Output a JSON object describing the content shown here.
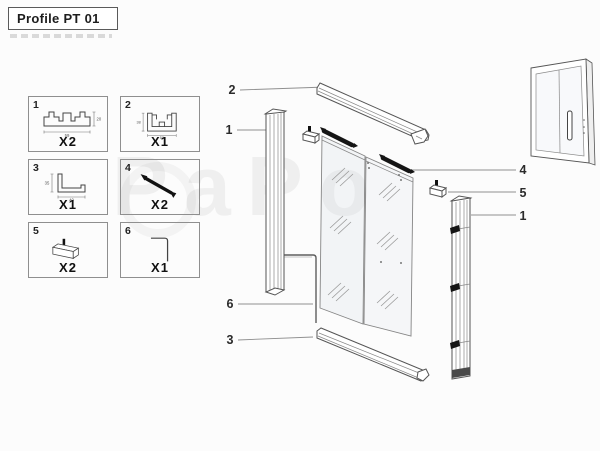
{
  "title": "Profile PT 01",
  "watermark": "PaPo",
  "parts": [
    {
      "num": "1",
      "qty": "X2",
      "dim_w": "59",
      "dim_h": "20"
    },
    {
      "num": "2",
      "qty": "X1",
      "dim_w": "50",
      "dim_h": "38"
    },
    {
      "num": "3",
      "qty": "X1",
      "dim_w": "40",
      "dim_h": "35"
    },
    {
      "num": "4",
      "qty": "X2"
    },
    {
      "num": "5",
      "qty": "X2"
    },
    {
      "num": "6",
      "qty": "X1"
    }
  ],
  "callouts": {
    "top_rail": "2",
    "left_profile": "1",
    "corner_seal": "6",
    "bottom_rail": "3",
    "roller_bar": "4",
    "guide_block": "5",
    "right_profile": "1"
  }
}
